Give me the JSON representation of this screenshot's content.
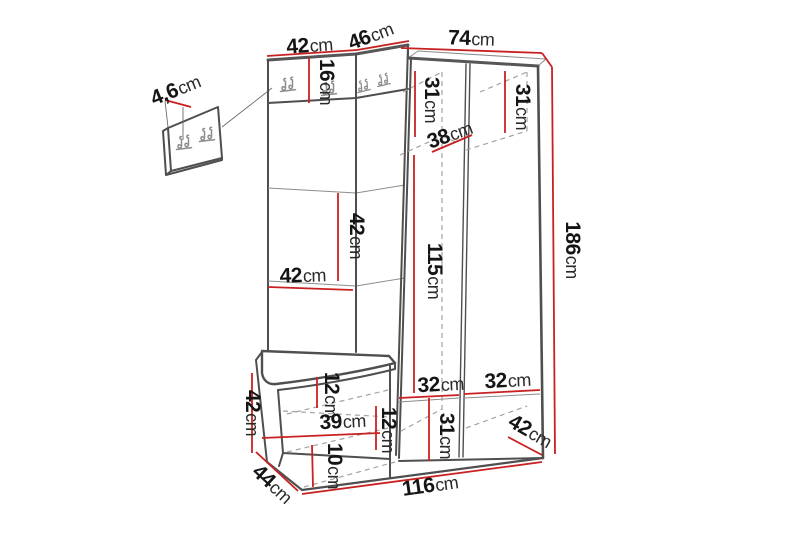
{
  "diagram": {
    "type": "furniture-dimension-drawing",
    "product": "corner hallway unit with coat hook panels, bench and open wardrobe",
    "unit": "cm",
    "colors": {
      "dimension_line": "#c92121",
      "outline": "#4f4f4f",
      "hidden_line": "#a3a3a3",
      "text": "#151515",
      "background": "#ffffff"
    },
    "icons": {
      "coat_hook": "double-coat-hook"
    },
    "dims": {
      "wall_panel_depth": {
        "num": "4,6",
        "unit": "cm"
      },
      "top_left_width": {
        "num": "42",
        "unit": "cm"
      },
      "top_corner_width": {
        "num": "46",
        "unit": "cm"
      },
      "top_right_width": {
        "num": "74",
        "unit": "cm"
      },
      "hook_strip_height": {
        "num": "16",
        "unit": "cm"
      },
      "upper_left_compartment_height": {
        "num": "31",
        "unit": "cm"
      },
      "upper_right_compartment_height": {
        "num": "31",
        "unit": "cm"
      },
      "corner_shelf_depth": {
        "num": "38",
        "unit": "cm"
      },
      "panel_cushion_height": {
        "num": "42",
        "unit": "cm"
      },
      "panel_cushion_width": {
        "num": "42",
        "unit": "cm"
      },
      "wardrobe_interior_height": {
        "num": "115",
        "unit": "cm"
      },
      "total_height": {
        "num": "186",
        "unit": "cm"
      },
      "bench_height": {
        "num": "42",
        "unit": "cm"
      },
      "seat_thickness": {
        "num": "12",
        "unit": "cm"
      },
      "bench_interior_width": {
        "num": "39",
        "unit": "cm"
      },
      "bench_shelf_gap": {
        "num": "12",
        "unit": "cm"
      },
      "bench_bottom_gap": {
        "num": "10",
        "unit": "cm"
      },
      "bench_depth": {
        "num": "44",
        "unit": "cm"
      },
      "total_width": {
        "num": "116",
        "unit": "cm"
      },
      "lower_left_compartment_width": {
        "num": "32",
        "unit": "cm"
      },
      "lower_right_compartment_width": {
        "num": "32",
        "unit": "cm"
      },
      "lower_compartment_height": {
        "num": "31",
        "unit": "cm"
      },
      "wardrobe_depth": {
        "num": "42",
        "unit": "cm"
      }
    }
  }
}
